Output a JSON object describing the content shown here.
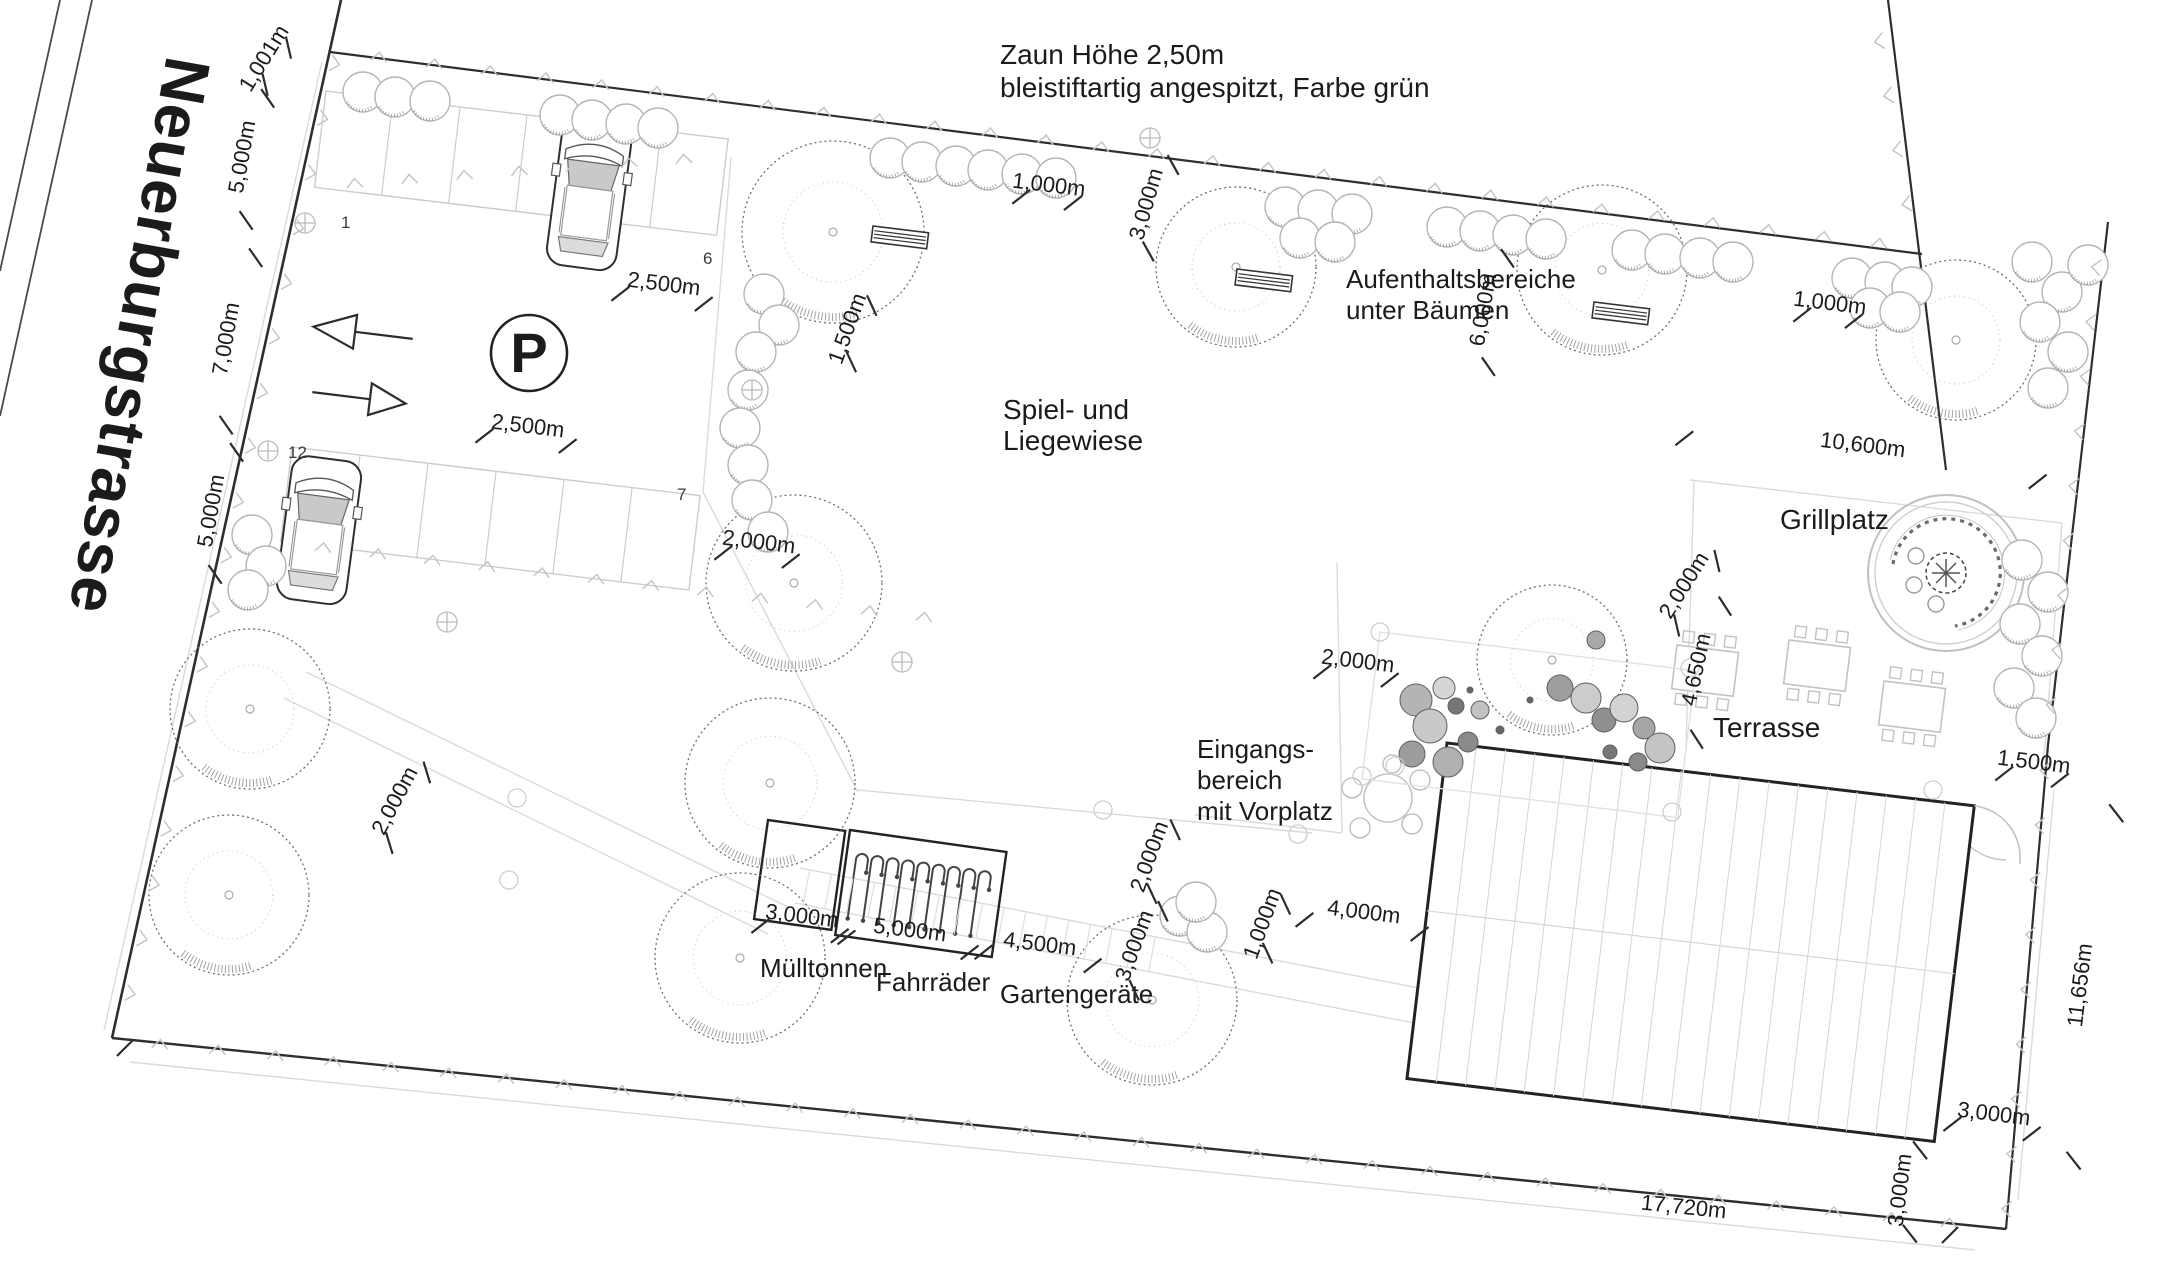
{
  "street": {
    "name": "Neuerburgstrasse"
  },
  "fence_note": [
    "Zaun Höhe 2,50m",
    "bleistiftartig angespitzt, Farbe grün"
  ],
  "labels": {
    "seating": [
      "Aufenthaltsbereiche",
      "unter Bäumen"
    ],
    "lawn": [
      "Spiel- und",
      "Liegewiese"
    ],
    "grill": "Grillplatz",
    "terrace": "Terrasse",
    "entrance": [
      "Eingangs-",
      "bereich",
      "mit Vorplatz"
    ],
    "bins": "Mülltonnen",
    "bikes": "Fahrräder",
    "garden_tools": "Gartengeräte"
  },
  "parking": {
    "symbol": "P",
    "stall_numbers": [
      {
        "text": "1",
        "x": 341,
        "y": 228
      },
      {
        "text": "6",
        "x": 703,
        "y": 264
      },
      {
        "text": "12",
        "x": 288,
        "y": 458
      },
      {
        "text": "7",
        "x": 677,
        "y": 500
      }
    ]
  },
  "dimensions": [
    {
      "text": "1,001m",
      "x": 270,
      "y": 62,
      "rot": -58,
      "span": 22
    },
    {
      "text": "5,000m",
      "x": 249,
      "y": 158,
      "rot": -80,
      "span": 62
    },
    {
      "text": "7,000m",
      "x": 233,
      "y": 340,
      "rot": -80,
      "span": 85
    },
    {
      "text": "5,000m",
      "x": 218,
      "y": 512,
      "rot": -80,
      "span": 62
    },
    {
      "text": "2,500m",
      "x": 663,
      "y": 291,
      "rot": 7,
      "span": 42
    },
    {
      "text": "2,500m",
      "x": 527,
      "y": 433,
      "rot": 7,
      "span": 42
    },
    {
      "text": "1,000m",
      "x": 1048,
      "y": 192,
      "rot": 7,
      "span": 26
    },
    {
      "text": "1,500m",
      "x": 854,
      "y": 331,
      "rot": -70,
      "span": 30
    },
    {
      "text": "3,000m",
      "x": 1153,
      "y": 206,
      "rot": -74,
      "span": 45
    },
    {
      "text": "2,000m",
      "x": 758,
      "y": 549,
      "rot": 7,
      "span": 34
    },
    {
      "text": "1,000m",
      "x": 1829,
      "y": 310,
      "rot": 7,
      "span": 26
    },
    {
      "text": "6,000m",
      "x": 1490,
      "y": 311,
      "rot": -80,
      "span": 55
    },
    {
      "text": "10,600m",
      "x": 1862,
      "y": 452,
      "rot": 7,
      "span": 178
    },
    {
      "text": "2,000m",
      "x": 401,
      "y": 804,
      "rot": -62,
      "span": 40
    },
    {
      "text": "2,000m",
      "x": 1357,
      "y": 668,
      "rot": 7,
      "span": 34
    },
    {
      "text": "2,000m",
      "x": 1690,
      "y": 589,
      "rot": -58,
      "span": 38
    },
    {
      "text": "4,650m",
      "x": 1703,
      "y": 671,
      "rot": -78,
      "span": 68
    },
    {
      "text": "1,500m",
      "x": 2033,
      "y": 769,
      "rot": 7,
      "span": 28
    },
    {
      "text": "11,656m",
      "x": 2087,
      "y": 986,
      "rot": -83,
      "span": 175
    },
    {
      "text": "3,000m",
      "x": 1993,
      "y": 1121,
      "rot": 7,
      "span": 40
    },
    {
      "text": "3,000m",
      "x": 1907,
      "y": 1191,
      "rot": -83,
      "span": 42
    },
    {
      "text": "17,720m",
      "x": 1683,
      "y": 1214,
      "rot": 6,
      "span": 0
    },
    {
      "text": "3,000m",
      "x": 801,
      "y": 923,
      "rot": 7,
      "span": 40
    },
    {
      "text": "5,000m",
      "x": 909,
      "y": 937,
      "rot": 7,
      "span": 62
    },
    {
      "text": "4,500m",
      "x": 1039,
      "y": 951,
      "rot": 7,
      "span": 55
    },
    {
      "text": "2,000m",
      "x": 1156,
      "y": 859,
      "rot": -70,
      "span": 34
    },
    {
      "text": "3,000m",
      "x": 1141,
      "y": 948,
      "rot": -70,
      "span": 42
    },
    {
      "text": "1,000m",
      "x": 1269,
      "y": 926,
      "rot": -70,
      "span": 26
    },
    {
      "text": "4,000m",
      "x": 1363,
      "y": 919,
      "rot": 7,
      "span": 58
    }
  ]
}
